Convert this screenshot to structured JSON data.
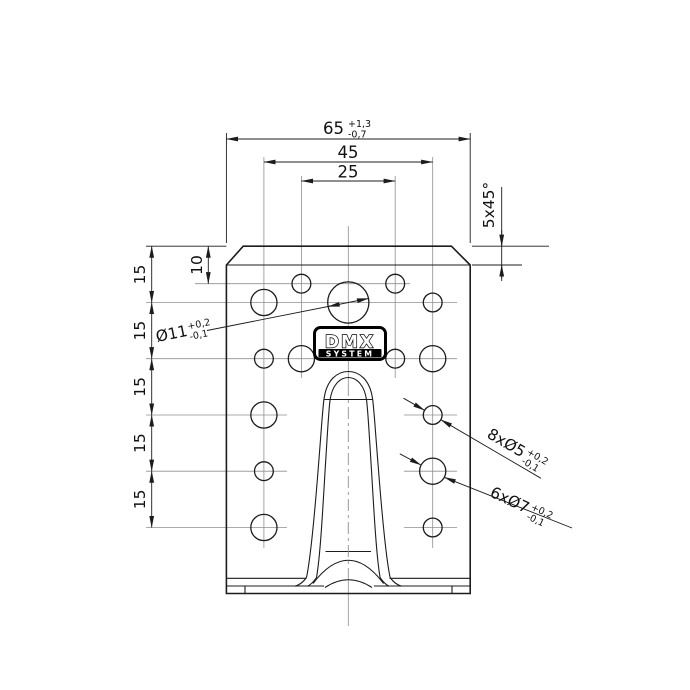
{
  "colors": {
    "line": "#1c1c1c",
    "centerline": "#8f8f8f",
    "background": "#ffffff",
    "logo_fg": "#000000",
    "logo_bg": "#ffffff"
  },
  "logo": {
    "line1": "DMX",
    "line2": "SYSTEM"
  },
  "dims": {
    "total_width": {
      "v": "65",
      "tp": "+1,3",
      "tm": "-0,7"
    },
    "outer_cols": {
      "v": "45"
    },
    "inner_cols": {
      "v": "25"
    },
    "chamfer": {
      "v": "5x45°"
    },
    "first_row": {
      "v": "10"
    },
    "rows": [
      "15",
      "15",
      "15",
      "15",
      "15"
    ],
    "d11": {
      "v": "Ø11",
      "tp": "+0,2",
      "tm": "-0,1"
    },
    "d5": {
      "v": "8xØ5",
      "tp": "+0,2",
      "tm": "-0,1"
    },
    "d7": {
      "v": "6xØ7",
      "tp": "+0,2",
      "tm": "-0,1"
    }
  },
  "holes": [
    {
      "x": 301.4,
      "y": 283.7,
      "r": 9.4,
      "label": "Ø5"
    },
    {
      "x": 395.2,
      "y": 283.7,
      "r": 9.4,
      "label": "Ø5"
    },
    {
      "x": 432.7,
      "y": 302.5,
      "r": 9.4,
      "label": "Ø5"
    },
    {
      "x": 263.9,
      "y": 358.7,
      "r": 9.4,
      "label": "Ø5"
    },
    {
      "x": 395.2,
      "y": 358.7,
      "r": 9.4,
      "label": "Ø5"
    },
    {
      "x": 432.7,
      "y": 415.0,
      "r": 9.4,
      "label": "Ø5"
    },
    {
      "x": 263.9,
      "y": 471.2,
      "r": 9.4,
      "label": "Ø5"
    },
    {
      "x": 432.7,
      "y": 527.5,
      "r": 9.4,
      "label": "Ø5"
    },
    {
      "x": 263.9,
      "y": 302.5,
      "r": 13.1,
      "label": "Ø7"
    },
    {
      "x": 301.4,
      "y": 358.7,
      "r": 13.1,
      "label": "Ø7"
    },
    {
      "x": 432.7,
      "y": 358.7,
      "r": 13.1,
      "label": "Ø7"
    },
    {
      "x": 263.9,
      "y": 415.0,
      "r": 13.1,
      "label": "Ø7"
    },
    {
      "x": 432.7,
      "y": 471.2,
      "r": 13.1,
      "label": "Ø7"
    },
    {
      "x": 263.9,
      "y": 527.5,
      "r": 13.1,
      "label": "Ø7"
    },
    {
      "x": 348.3,
      "y": 302.5,
      "r": 20.6,
      "label": "Ø11"
    }
  ]
}
